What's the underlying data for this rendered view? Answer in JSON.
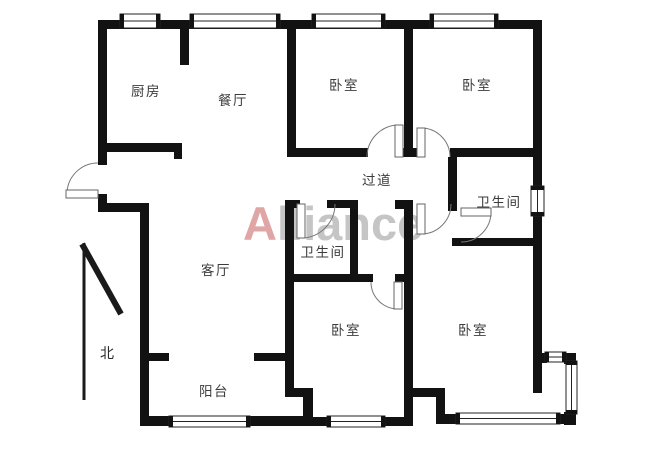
{
  "page": {
    "background": "#ffffff"
  },
  "watermark": {
    "prefix": "A",
    "suffix": "lliance",
    "prefix_color": "#d98f8f",
    "suffix_color": "#b7b7b7",
    "x": 243,
    "y": 240,
    "font_size": 47
  },
  "compass": {
    "label": "北",
    "x": 107,
    "y": 358,
    "lines": [
      [
        84,
        243,
        84,
        400,
        3
      ],
      [
        82,
        244,
        121,
        314,
        6
      ]
    ]
  },
  "rooms": [
    {
      "id": "kitchen",
      "label": "厨房",
      "x": 146,
      "y": 96
    },
    {
      "id": "dining-room",
      "label": "餐厅",
      "x": 233,
      "y": 105
    },
    {
      "id": "bedroom-top-middle",
      "label": "卧室",
      "x": 344,
      "y": 90
    },
    {
      "id": "bedroom-top-right",
      "label": "卧室",
      "x": 477,
      "y": 90
    },
    {
      "id": "hallway",
      "label": "过道",
      "x": 377,
      "y": 185
    },
    {
      "id": "bathroom-right",
      "label": "卫生间",
      "x": 499,
      "y": 207
    },
    {
      "id": "bathroom-center",
      "label": "卫生间",
      "x": 323,
      "y": 257
    },
    {
      "id": "living-room",
      "label": "客厅",
      "x": 216,
      "y": 275
    },
    {
      "id": "balcony",
      "label": "阳台",
      "x": 214,
      "y": 396
    },
    {
      "id": "bedroom-bottom-middle",
      "label": "卧室",
      "x": 346,
      "y": 335
    },
    {
      "id": "bedroom-bottom-right",
      "label": "卧室",
      "x": 473,
      "y": 335
    }
  ],
  "geometry": {
    "wall_color": "#121212",
    "door_stroke": "#777777",
    "window_stroke": "#222222",
    "walls": [
      [
        98,
        20,
        444,
        9
      ],
      [
        98,
        20,
        9,
        145
      ],
      [
        98,
        194,
        9,
        18
      ],
      [
        98,
        203,
        51,
        9
      ],
      [
        140,
        203,
        9,
        220
      ],
      [
        148,
        353,
        21,
        8
      ],
      [
        254,
        353,
        32,
        8
      ],
      [
        140,
        416,
        31,
        10
      ],
      [
        248,
        416,
        63,
        10
      ],
      [
        303,
        388,
        10,
        38
      ],
      [
        285,
        388,
        28,
        9
      ],
      [
        313,
        417,
        16,
        9
      ],
      [
        383,
        417,
        22,
        9
      ],
      [
        285,
        200,
        9,
        192
      ],
      [
        285,
        200,
        15,
        8
      ],
      [
        327,
        200,
        31,
        8
      ],
      [
        350,
        200,
        8,
        82
      ],
      [
        285,
        274,
        88,
        8
      ],
      [
        395,
        274,
        18,
        8
      ],
      [
        404,
        200,
        9,
        226
      ],
      [
        395,
        200,
        18,
        9
      ],
      [
        404,
        388,
        41,
        9
      ],
      [
        436,
        388,
        9,
        30
      ],
      [
        436,
        414,
        22,
        10
      ],
      [
        558,
        414,
        15,
        10
      ],
      [
        287,
        28,
        9,
        129
      ],
      [
        287,
        148,
        81,
        9
      ],
      [
        395,
        148,
        27,
        9
      ],
      [
        450,
        148,
        92,
        9
      ],
      [
        404,
        28,
        9,
        129
      ],
      [
        180,
        20,
        9,
        45
      ],
      [
        98,
        143,
        84,
        9
      ],
      [
        174,
        150,
        8,
        9
      ],
      [
        533,
        20,
        9,
        373
      ],
      [
        448,
        157,
        9,
        54
      ],
      [
        452,
        238,
        90,
        8
      ],
      [
        538,
        353,
        9,
        10
      ],
      [
        564,
        353,
        12,
        11
      ],
      [
        564,
        412,
        12,
        13
      ]
    ],
    "windows": [
      {
        "x": 120,
        "y": 14,
        "w": 40,
        "h": 14,
        "dir": "h",
        "name": "window-kitchen-top"
      },
      {
        "x": 190,
        "y": 14,
        "w": 90,
        "h": 14,
        "dir": "h",
        "name": "window-dining-top"
      },
      {
        "x": 312,
        "y": 14,
        "w": 73,
        "h": 14,
        "dir": "h",
        "name": "window-bedroom-top-middle"
      },
      {
        "x": 430,
        "y": 14,
        "w": 68,
        "h": 14,
        "dir": "h",
        "name": "window-bedroom-top-right"
      },
      {
        "x": 531,
        "y": 186,
        "w": 13,
        "h": 30,
        "dir": "v",
        "name": "window-bathroom-right"
      },
      {
        "x": 169,
        "y": 416,
        "w": 81,
        "h": 11,
        "dir": "h",
        "name": "window-balcony"
      },
      {
        "x": 327,
        "y": 416,
        "w": 58,
        "h": 11,
        "dir": "h",
        "name": "window-bedroom-bottom-middle"
      },
      {
        "x": 456,
        "y": 413,
        "w": 104,
        "h": 11,
        "dir": "h",
        "name": "window-bedroom-bottom-right"
      },
      {
        "x": 545,
        "y": 352,
        "w": 21,
        "h": 10,
        "dir": "h",
        "name": "window-bay-top"
      },
      {
        "x": 566,
        "y": 361,
        "w": 11,
        "h": 53,
        "dir": "v",
        "name": "window-bay-right"
      }
    ],
    "doors": [
      {
        "cx": 98,
        "cy": 194,
        "r": 31,
        "a1": 270,
        "a2": 180,
        "leaf": [
          66,
          190,
          32,
          8
        ],
        "name": "door-entry"
      },
      {
        "cx": 399,
        "cy": 157,
        "r": 32,
        "a1": 180,
        "a2": 270,
        "leaf": [
          395,
          125,
          8,
          32
        ],
        "name": "door-bedroom-top-middle"
      },
      {
        "cx": 421,
        "cy": 157,
        "r": 29,
        "a1": 270,
        "a2": 360,
        "leaf": [
          417,
          128,
          8,
          29
        ],
        "name": "door-bedroom-top-right"
      },
      {
        "cx": 301,
        "cy": 204,
        "r": 34,
        "a1": 90,
        "a2": 0,
        "leaf": [
          297,
          204,
          8,
          34
        ],
        "name": "door-bathroom-center"
      },
      {
        "cx": 421,
        "cy": 204,
        "r": 30,
        "a1": 90,
        "a2": 0,
        "leaf": [
          417,
          204,
          8,
          30
        ],
        "name": "door-hall-passage"
      },
      {
        "cx": 461,
        "cy": 212,
        "r": 30,
        "a1": 0,
        "a2": 90,
        "leaf": [
          461,
          208,
          30,
          8
        ],
        "name": "door-bathroom-right"
      },
      {
        "cx": 398,
        "cy": 282,
        "r": 27,
        "a1": 90,
        "a2": 180,
        "leaf": [
          394,
          282,
          8,
          27
        ],
        "name": "door-bedroom-bottom-middle"
      }
    ]
  }
}
